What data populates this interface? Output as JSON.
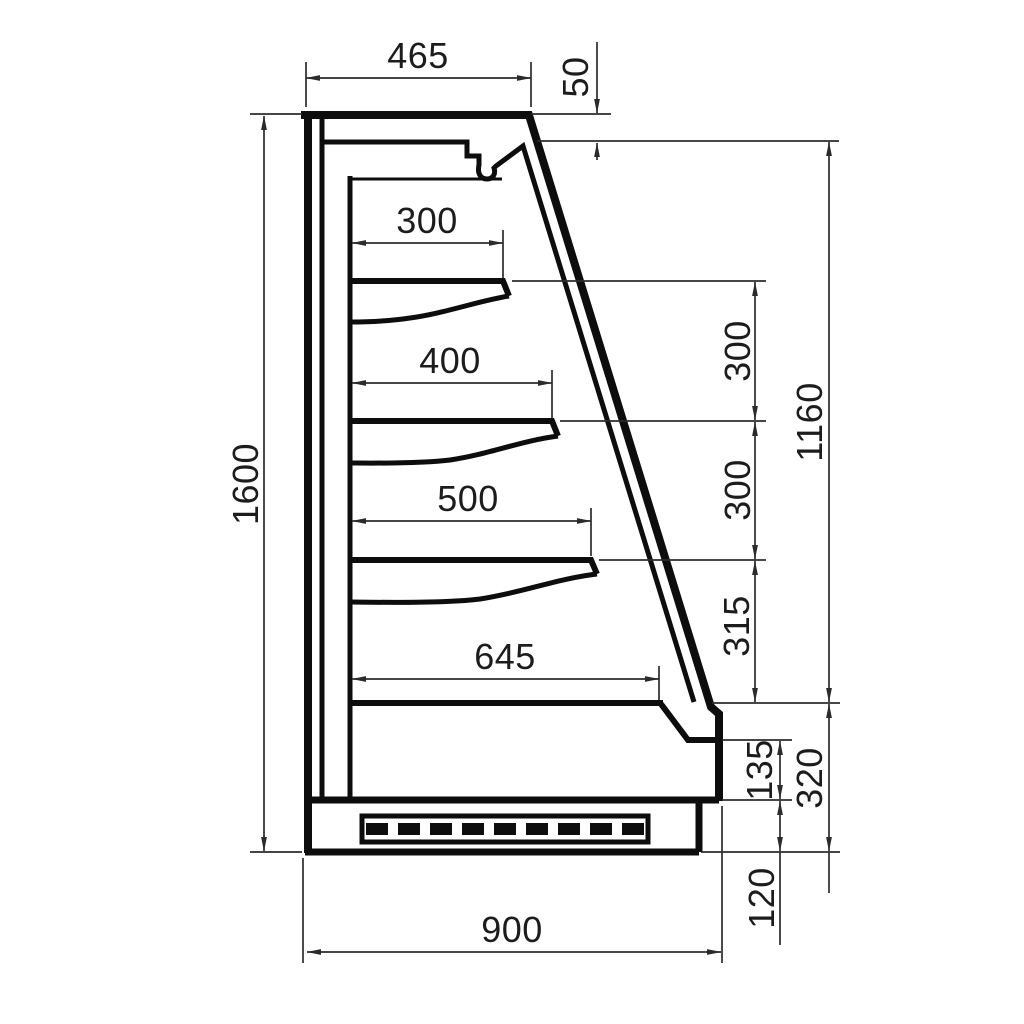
{
  "diagram": {
    "figure_type": "dimensioned technical drawing, side cross-section",
    "subject": "open-front display cabinet with three shelves, base well and ventilated plinth",
    "dimensions": {
      "top_depth": "465",
      "canopy_front_drop": "50",
      "overall_height": "1600",
      "shelf_top_depth": "300",
      "shelf_middle_depth": "400",
      "shelf_bottom_depth": "500",
      "well_depth": "645",
      "shelf_spacing_top": "300",
      "shelf_spacing_middle": "300",
      "shelf_spacing_bottom": "315",
      "opening_height": "1160",
      "bumper_height": "135",
      "base_section_height": "320",
      "plinth_height": "120",
      "overall_depth": "900"
    }
  }
}
